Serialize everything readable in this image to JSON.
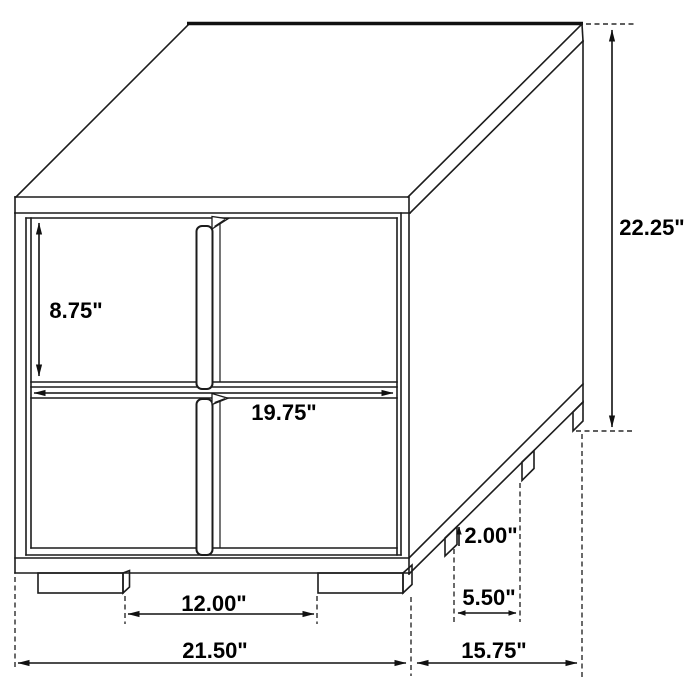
{
  "diagram": {
    "kind": "furniture-dimension-drawing",
    "product": "two-drawer nightstand, isometric line drawing",
    "units": "inches",
    "colors": {
      "background": "#ffffff",
      "line": "#1c1c1c",
      "text": "#000000"
    },
    "dimensions": {
      "overall_height": {
        "label": "22.25\"",
        "value": 22.25
      },
      "overall_width": {
        "label": "21.50\"",
        "value": 21.5
      },
      "overall_depth": {
        "label": "15.75\"",
        "value": 15.75
      },
      "drawer_height": {
        "label": "8.75\"",
        "value": 8.75
      },
      "drawer_width": {
        "label": "19.75\"",
        "value": 19.75
      },
      "leg_height": {
        "label": "2.00\"",
        "value": 2.0
      },
      "side_leg_spacing": {
        "label": "5.50\"",
        "value": 5.5
      },
      "front_leg_spacing": {
        "label": "12.00\"",
        "value": 12.0
      }
    }
  }
}
